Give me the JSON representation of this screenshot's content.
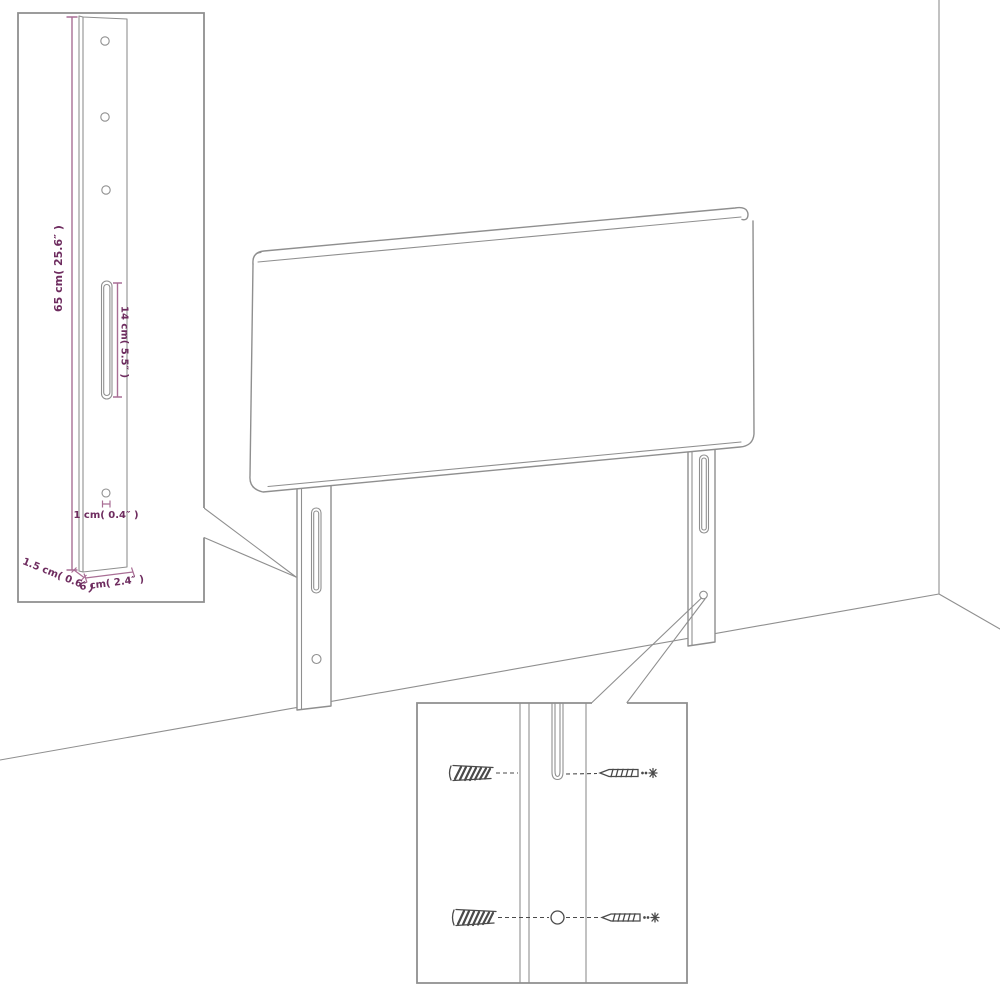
{
  "colors": {
    "background": "#ffffff",
    "line_gray": "#8f8f8f",
    "dimension_purple": "#a96e95",
    "label_purple": "#6e2c5f",
    "hardware_dark": "#4a4a4a"
  },
  "insets": {
    "leg_dimensions": {
      "height_label": "65 cm( 25.6″ )",
      "slot_label": "14 cm( 5.5″ )",
      "hole_label": "1 cm( 0.4″ )",
      "thickness_label": "1.5 cm( 0.6″ )",
      "width_label": "6 cm( 2.4″ )"
    }
  }
}
